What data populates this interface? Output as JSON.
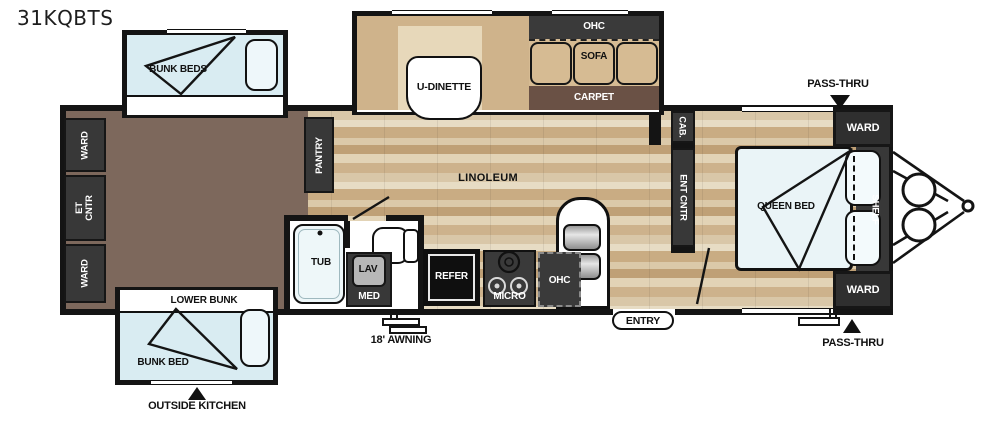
{
  "title": "31KQBTS",
  "labels": {
    "bunk_beds": "BUNK BEDS",
    "ward": "WARD",
    "et_cntr": "ET CNTR",
    "pantry": "PANTRY",
    "u_dinette": "U-DINETTE",
    "ohc": "OHC",
    "sofa": "SOFA",
    "carpet": "CARPET",
    "linoleum": "LINOLEUM",
    "lower_bunk": "LOWER BUNK",
    "bunk_bed": "BUNK BED",
    "outside_kitchen": "OUTSIDE KITCHEN",
    "tub": "TUB",
    "lav": "LAV",
    "med": "MED",
    "refer": "REFER",
    "micro": "MICRO",
    "awning": "18' AWNING",
    "entry": "ENTRY",
    "cab": "CAB.",
    "ent_cntr": "ENT CNTR",
    "queen_bed": "QUEEN BED",
    "shelf": "SHELF",
    "pass_thru": "PASS-THRU"
  },
  "colors": {
    "wall": "#141414",
    "wood_floor": "#d7c5a5",
    "bunk_room_floor": "#7d685c",
    "carpet": "#6a5145",
    "cushion_tan": "#d6bb93",
    "bed_blue": "#d9ecf2",
    "cabinet_dark": "#383838"
  }
}
